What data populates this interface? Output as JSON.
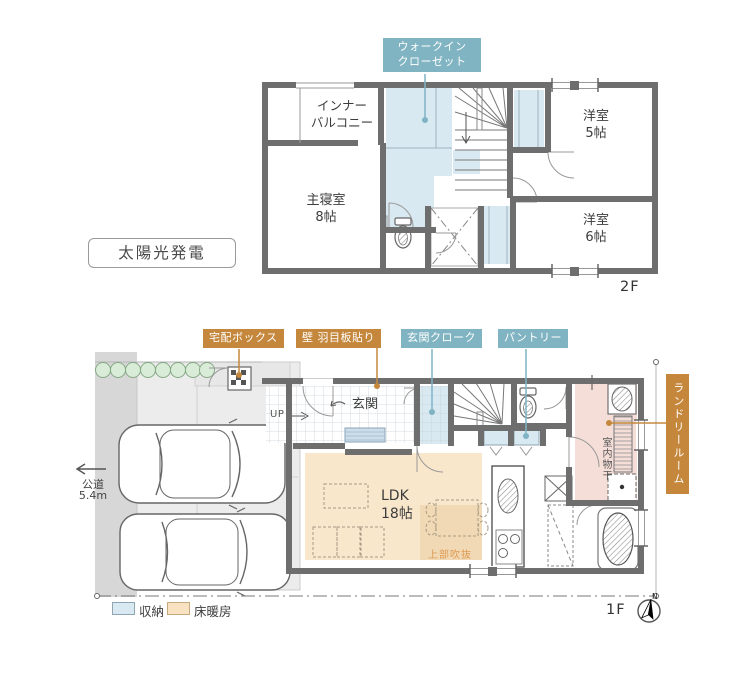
{
  "floor2": {
    "floor_label": "2F",
    "solar_badge": "太陽光発電",
    "callout_walk_in_closet": "ウォークイン\nクローゼット",
    "room_inner_balcony": "インナー\nバルコニー",
    "room_master_bedroom": "主寝室\n8帖",
    "room_western_5": "洋室\n5帖",
    "room_western_6": "洋室\n6帖"
  },
  "floor1": {
    "floor_label": "1F",
    "callout_delivery_box": "宅配ボックス",
    "callout_wall_paneling": "壁 羽目板貼り",
    "callout_entrance_cloak": "玄関クローク",
    "callout_pantry": "パントリー",
    "callout_laundry_room": "ランドリールーム",
    "room_entrance": "玄関",
    "room_ldk": "LDK\n18帖",
    "label_stairs_up": "UP",
    "label_void_above": "上部吹抜",
    "label_indoor_drying": "室内物干",
    "road_label": "公道",
    "road_width": "5.4m",
    "compass_north": "N"
  },
  "legend": {
    "storage_label": "収納",
    "floor_heating_label": "床暖房"
  },
  "colors": {
    "teal_label_bg": "#80b4c2",
    "orange_label_bg": "#c5873c",
    "storage_fill": "#d9e9f2",
    "floor_heating_fill": "#f9e7cb",
    "laundry_fill": "#f5ded8",
    "wall_gray": "#6e6e6e"
  }
}
